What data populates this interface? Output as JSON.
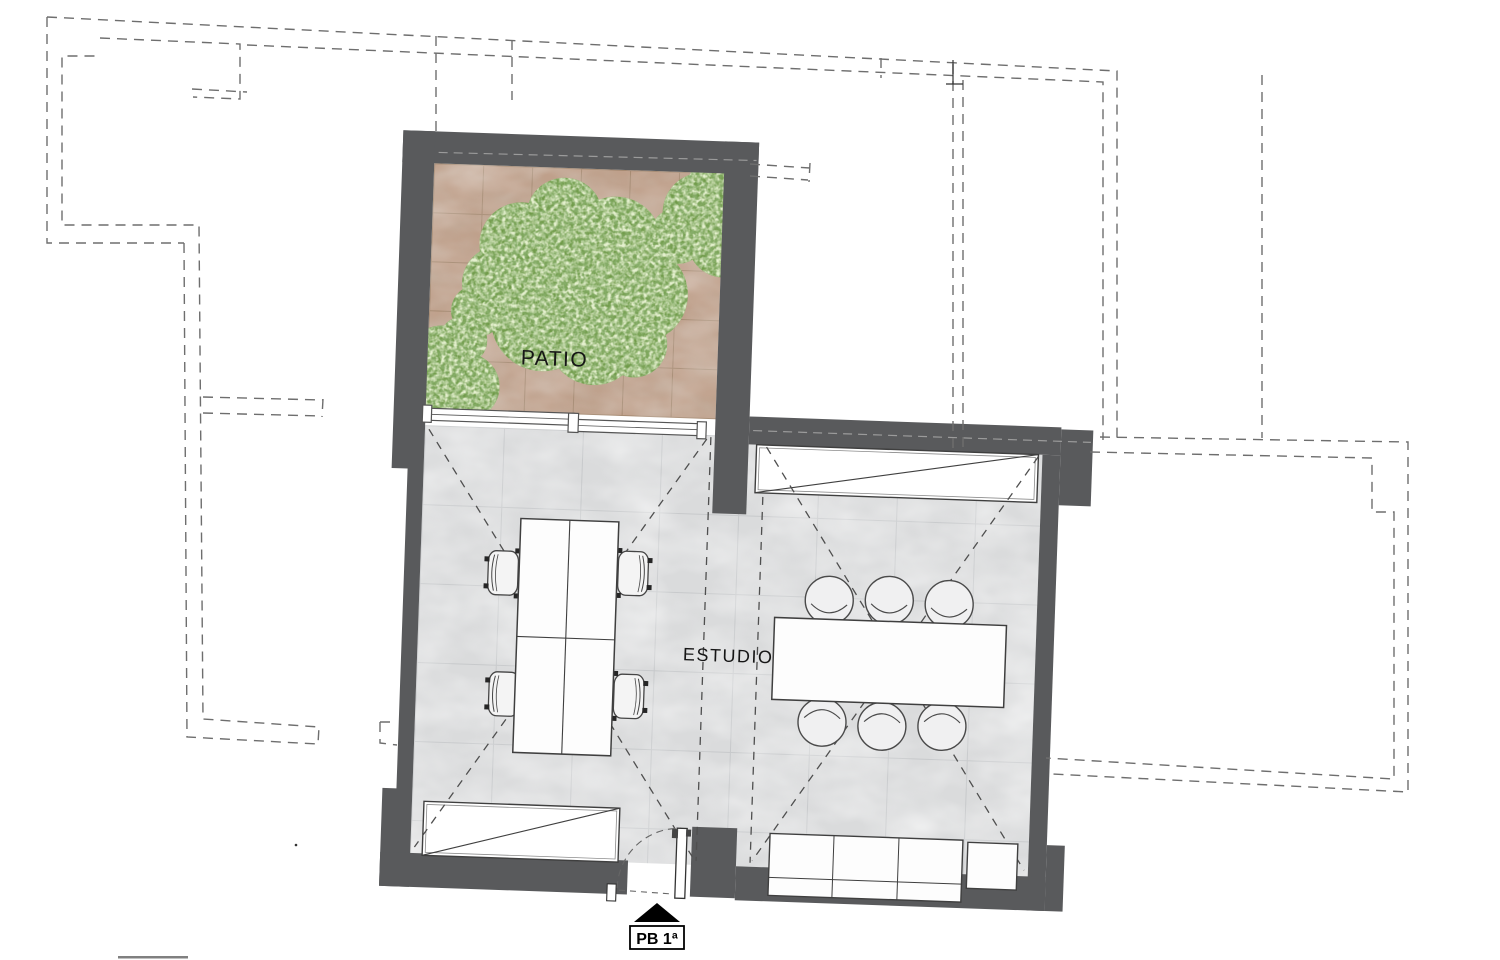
{
  "plan": {
    "labels": {
      "patio": "PATIO",
      "studio": "ESTUDIO",
      "entry": "PB 1ª"
    },
    "colors": {
      "wall": "#595a5c",
      "patio_tile": "#bfa08b",
      "patio_tile_joint": "#a3876e",
      "studio_tile": "#dadbdc",
      "studio_tile_joint": "#c7c9cb",
      "foliage": "#6f9a48",
      "foliage_dark": "#3d6b24",
      "foliage_light": "#c7d9a4",
      "neighbor_dashed_outline": "#6e6e6e",
      "interior_dashed": "#4f4f4f",
      "furniture_fill": "#ffffff",
      "furniture_outline": "#3f3f3f",
      "entry_marker": "#000000",
      "label_text": "#161616"
    }
  }
}
